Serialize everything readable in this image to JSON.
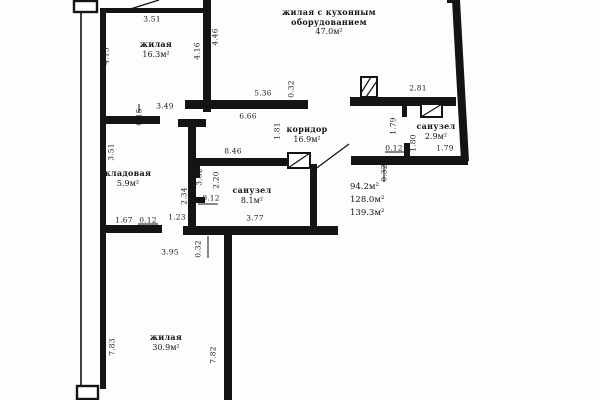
{
  "plan": {
    "rooms": [
      {
        "name": "жилая",
        "area": "16.3м²"
      },
      {
        "name_line1": "жилая с кухонным",
        "name_line2": "оборудованием",
        "area": "47.0м²"
      },
      {
        "name": "коридор",
        "area": "16.9м²"
      },
      {
        "name": "кладовая",
        "area": "5.9м²"
      },
      {
        "name": "санузел",
        "area": "8.1м²"
      },
      {
        "name": "санузел",
        "area": "2.9м²"
      },
      {
        "name": "жилая",
        "area": "30.9м²"
      }
    ],
    "area_summary": {
      "line1": "94.2м²",
      "line2": "128.0м²",
      "line3": "139.3м²"
    },
    "dimensions": [
      {
        "text": "3.51",
        "x": 152,
        "y": 19,
        "rot": false
      },
      {
        "text": "4.15",
        "x": 106,
        "y": 56,
        "rot": true
      },
      {
        "text": "4.16",
        "x": 197,
        "y": 51,
        "rot": true
      },
      {
        "text": "4.46",
        "x": 215,
        "y": 37,
        "rot": true
      },
      {
        "text": "0.15",
        "x": 139,
        "y": 117,
        "rot": true
      },
      {
        "text": "3.49",
        "x": 165,
        "y": 106,
        "rot": false
      },
      {
        "text": "5.36",
        "x": 263,
        "y": 93,
        "rot": false
      },
      {
        "text": "0.32",
        "x": 291,
        "y": 89,
        "rot": true
      },
      {
        "text": "6.66",
        "x": 248,
        "y": 116,
        "rot": false
      },
      {
        "text": "2.81",
        "x": 418,
        "y": 88,
        "rot": false
      },
      {
        "text": "1.79",
        "x": 393,
        "y": 126,
        "rot": true
      },
      {
        "text": "0.12",
        "x": 394,
        "y": 148,
        "rot": false
      },
      {
        "text": "1.80",
        "x": 413,
        "y": 143,
        "rot": true
      },
      {
        "text": "1.79",
        "x": 445,
        "y": 148,
        "rot": false
      },
      {
        "text": "1.81",
        "x": 277,
        "y": 131,
        "rot": true
      },
      {
        "text": "8.46",
        "x": 233,
        "y": 151,
        "rot": false
      },
      {
        "text": "2.20",
        "x": 216,
        "y": 180,
        "rot": true
      },
      {
        "text": "0.12",
        "x": 211,
        "y": 198,
        "rot": false
      },
      {
        "text": "2.34",
        "x": 184,
        "y": 196,
        "rot": true
      },
      {
        "text": "3.77",
        "x": 255,
        "y": 218,
        "rot": false
      },
      {
        "text": "0.32",
        "x": 384,
        "y": 173,
        "rot": true
      },
      {
        "text": "3.51",
        "x": 111,
        "y": 152,
        "rot": true
      },
      {
        "text": "3.52",
        "x": 199,
        "y": 177,
        "rot": true
      },
      {
        "text": "1.67",
        "x": 124,
        "y": 220,
        "rot": false
      },
      {
        "text": "0.12",
        "x": 148,
        "y": 220,
        "rot": false
      },
      {
        "text": "1.23",
        "x": 177,
        "y": 217,
        "rot": false
      },
      {
        "text": "3.95",
        "x": 170,
        "y": 252,
        "rot": false
      },
      {
        "text": "0.32",
        "x": 198,
        "y": 249,
        "rot": true
      },
      {
        "text": "7.83",
        "x": 112,
        "y": 347,
        "rot": true
      },
      {
        "text": "7.82",
        "x": 213,
        "y": 355,
        "rot": true
      }
    ]
  }
}
